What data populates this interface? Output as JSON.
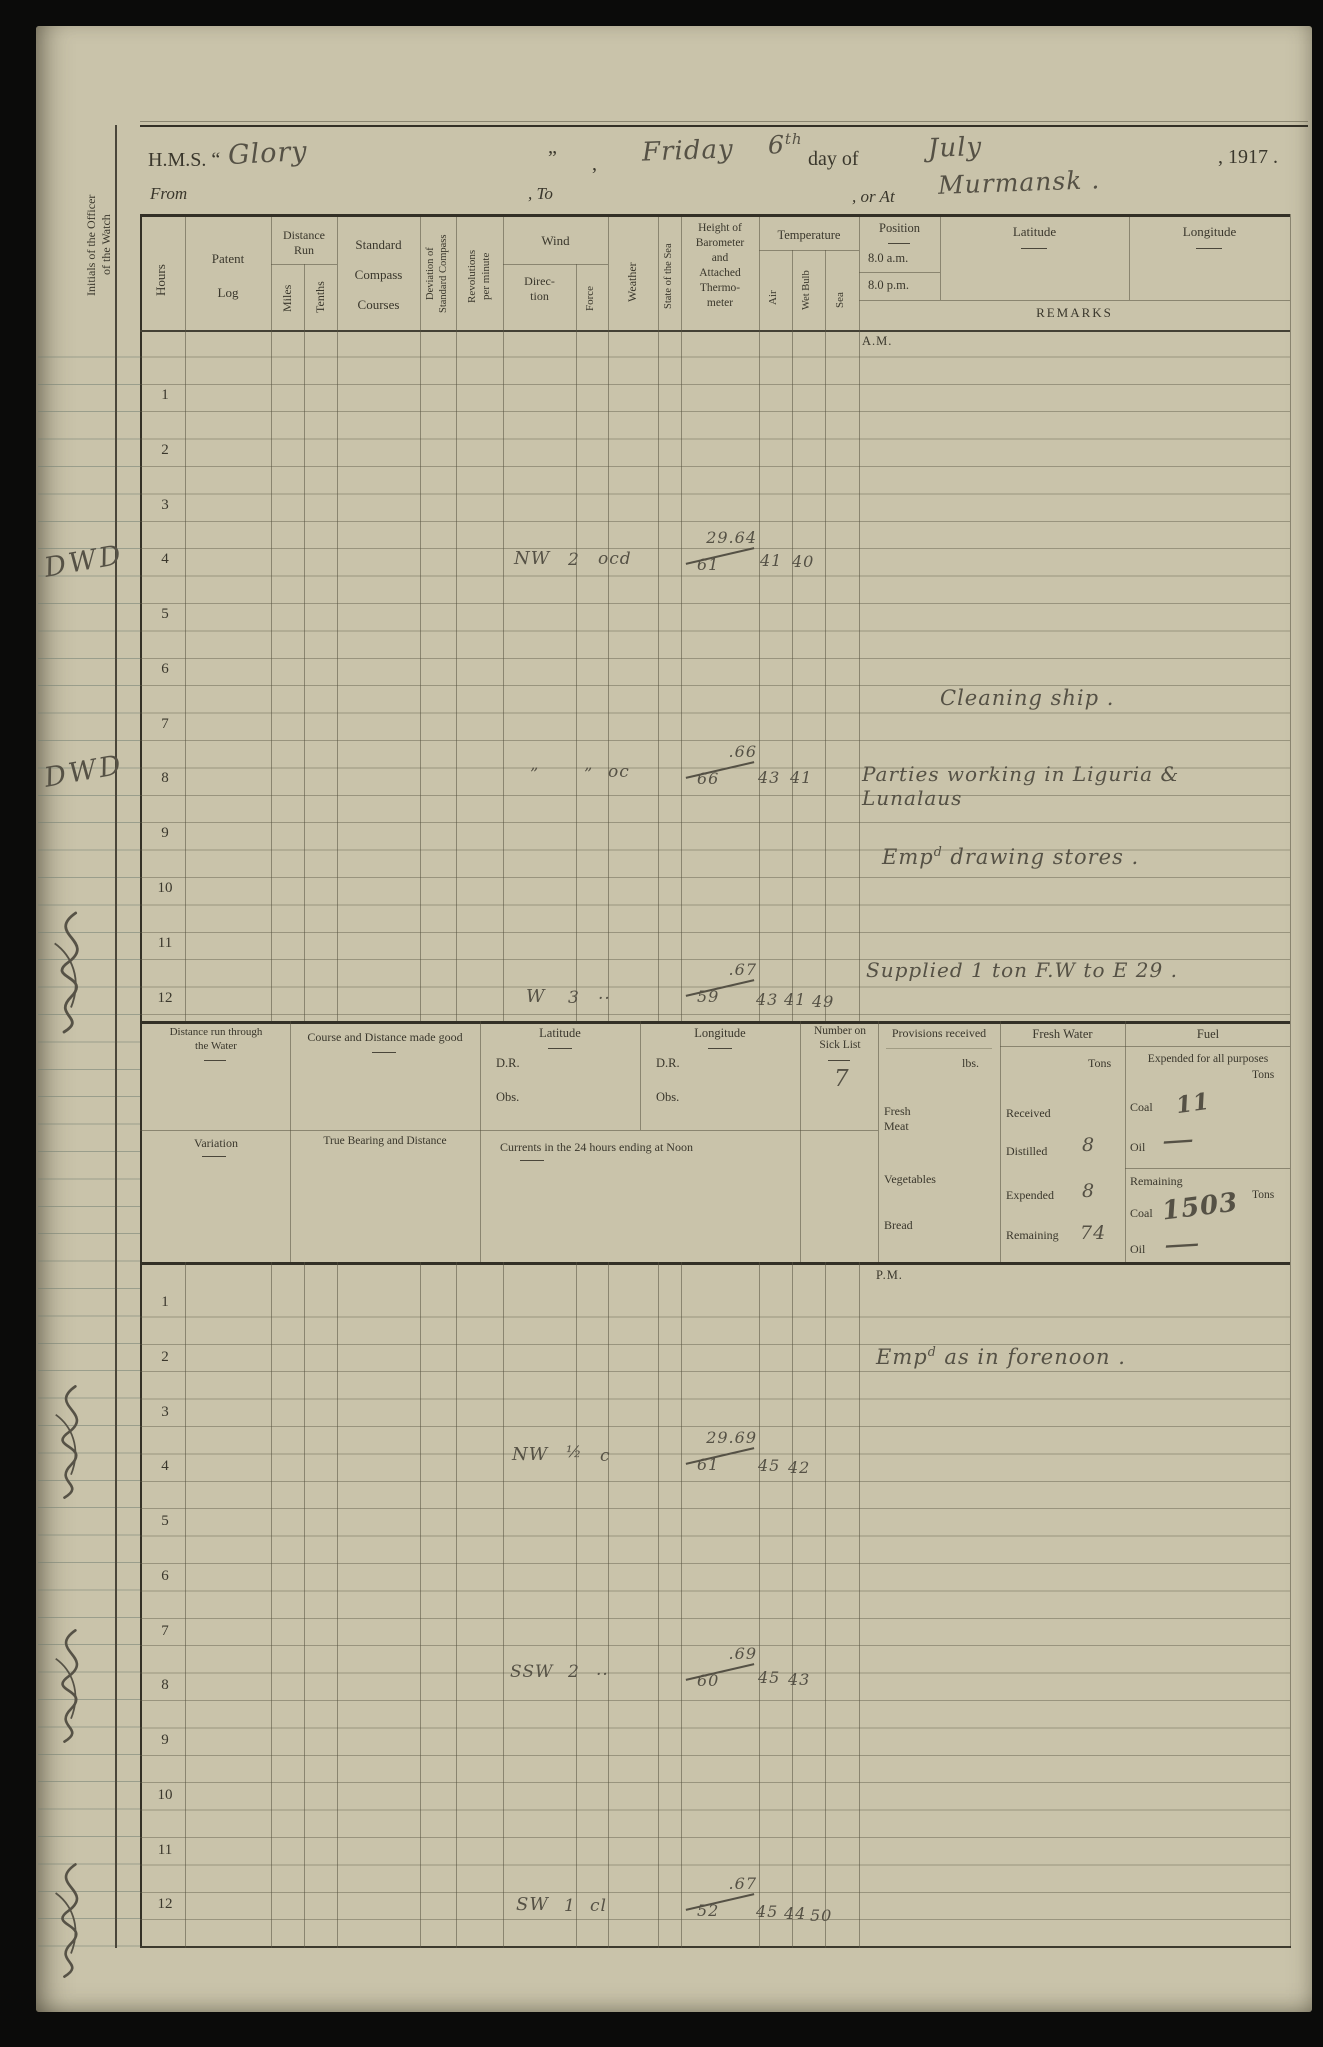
{
  "header": {
    "hms": "H.M.S. “",
    "ship": "Glory",
    "endq": "”",
    "c1": ",",
    "weekday": "Friday",
    "day": "6",
    "daysup": "th",
    "dayof": "day of",
    "month": "July",
    "year": ", 1917 .",
    "from": "From",
    "to": ", To",
    "orat": ", or At",
    "place": "Murmansk ."
  },
  "cols": {
    "hours": "Hours",
    "patent": "Patent\nLog",
    "distrun": "Distance\nRun",
    "miles": "Miles",
    "tenths": "Tenths",
    "stdcompass": "Standard\nCompass\nCourses",
    "deviation": "Deviation of\nStandard Compass",
    "revs": "Revolutions\nper minute",
    "wind": "Wind",
    "direction": "Direc-\ntion",
    "force": "Force",
    "weather": "Weather",
    "seastate": "State of the Sea",
    "baro": "Height of\nBarometer\nand\nAttached\nThermo-\nmeter",
    "temp": "Temperature",
    "air": "Air",
    "wet": "Wet Bulb",
    "sea": "Sea",
    "position": "Position",
    "am8": "8.0 a.m.",
    "pm8": "8.0 p.m.",
    "latitude": "Latitude",
    "longitude": "Longitude",
    "remarks": "REMARKS"
  },
  "am": {
    "label": "A.M.",
    "hours": [
      "1",
      "2",
      "3",
      "4",
      "5",
      "6",
      "7",
      "8",
      "9",
      "10",
      "11",
      "12"
    ],
    "r4": {
      "dir": "NW",
      "force": "2",
      "wx": "ocd",
      "bt": "29.64",
      "bb": "61",
      "air": "41",
      "wet": "40"
    },
    "r7_remark": "Cleaning ship .",
    "r8": {
      "dir": "”",
      "force": "”",
      "wx": "oc",
      "bt": ".66",
      "bb": "66",
      "air": "43",
      "wet": "41",
      "remark": "Parties working in Liguria & Lunalaus"
    },
    "r9": {
      "pre": "Emp",
      "sup": "d",
      "post": " drawing stores ."
    },
    "r12": {
      "dir": "W",
      "force": "3",
      "wx": "..",
      "bt": ".67",
      "bb": "59",
      "air": "43",
      "wet": "41",
      "sea": "49",
      "remark": "Supplied 1 ton F.W to E 29 ."
    }
  },
  "noon": {
    "dist_water": "Distance run through\nthe Water",
    "course": "Course and Distance made good",
    "latitude": "Latitude",
    "longitude": "Longitude",
    "dr": "D.R.",
    "obs": "Obs.",
    "sick": "Number on\nSick List",
    "sick_value": "7",
    "provisions": "Provisions received",
    "lbs": "lbs.",
    "fresh_meat": "Fresh\nMeat",
    "vegetables": "Vegetables",
    "bread": "Bread",
    "fw": "Fresh Water",
    "tons": "Tons",
    "received": "Received",
    "distilled": "Distilled",
    "expended": "Expended",
    "remaining": "Remaining",
    "fw_distilled": "8",
    "fw_expended": "8",
    "fw_remaining": "74",
    "fuel": "Fuel",
    "fuel_exp_hdr": "Expended for all purposes",
    "coal": "Coal",
    "oil": "Oil",
    "coal_exp": "11",
    "oil_exp": "—",
    "coal_rem": "1503",
    "oil_rem": "—",
    "variation": "Variation",
    "bearing": "True Bearing and Distance",
    "currents": "Currents in the 24 hours ending at Noon"
  },
  "pm": {
    "label": "P.M.",
    "hours": [
      "1",
      "2",
      "3",
      "4",
      "5",
      "6",
      "7",
      "8",
      "9",
      "10",
      "11",
      "12"
    ],
    "r2": {
      "pre": "Emp",
      "sup": "d",
      "post": " as in forenoon ."
    },
    "r4": {
      "dir": "NW",
      "force": "½",
      "wx": "c",
      "bt": "29.69",
      "bb": "61",
      "air": "45",
      "wet": "42"
    },
    "r8": {
      "dir": "SSW",
      "force": "2",
      "wx": "..",
      "bt": ".69",
      "bb": "60",
      "air": "45",
      "wet": "43"
    },
    "r12": {
      "dir": "SW",
      "force": "1",
      "wx": "cl",
      "bt": ".67",
      "bb": "52",
      "air": "45",
      "wet": "44",
      "sea": "50"
    }
  },
  "margin": {
    "initials_label": "Initials of the Officer\nof the Watch",
    "signature": "DWD"
  }
}
